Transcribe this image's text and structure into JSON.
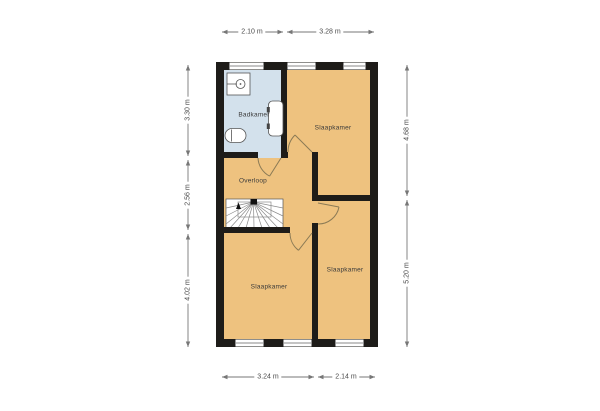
{
  "rooms": {
    "badkamer": "Badkamer",
    "slaapkamer_top": "Slaapkamer",
    "overloop": "Overloop",
    "slaapkamer_left": "Slaapkamer",
    "slaapkamer_right": "Slaapkamer"
  },
  "dimensions": {
    "top": [
      "2.10 m",
      "3.28 m"
    ],
    "bottom": [
      "3.24 m",
      "2.14 m"
    ],
    "left": [
      "3.30 m",
      "2.56 m",
      "4.02 m"
    ],
    "right": [
      "4.68 m",
      "5.20 m"
    ]
  },
  "colors": {
    "floor_orange": "#eec27f",
    "bathroom_blue": "#d3e1ec",
    "wall_black": "#1e1c19",
    "door_line": "#8a7a55",
    "dimension_line": "#777777"
  }
}
